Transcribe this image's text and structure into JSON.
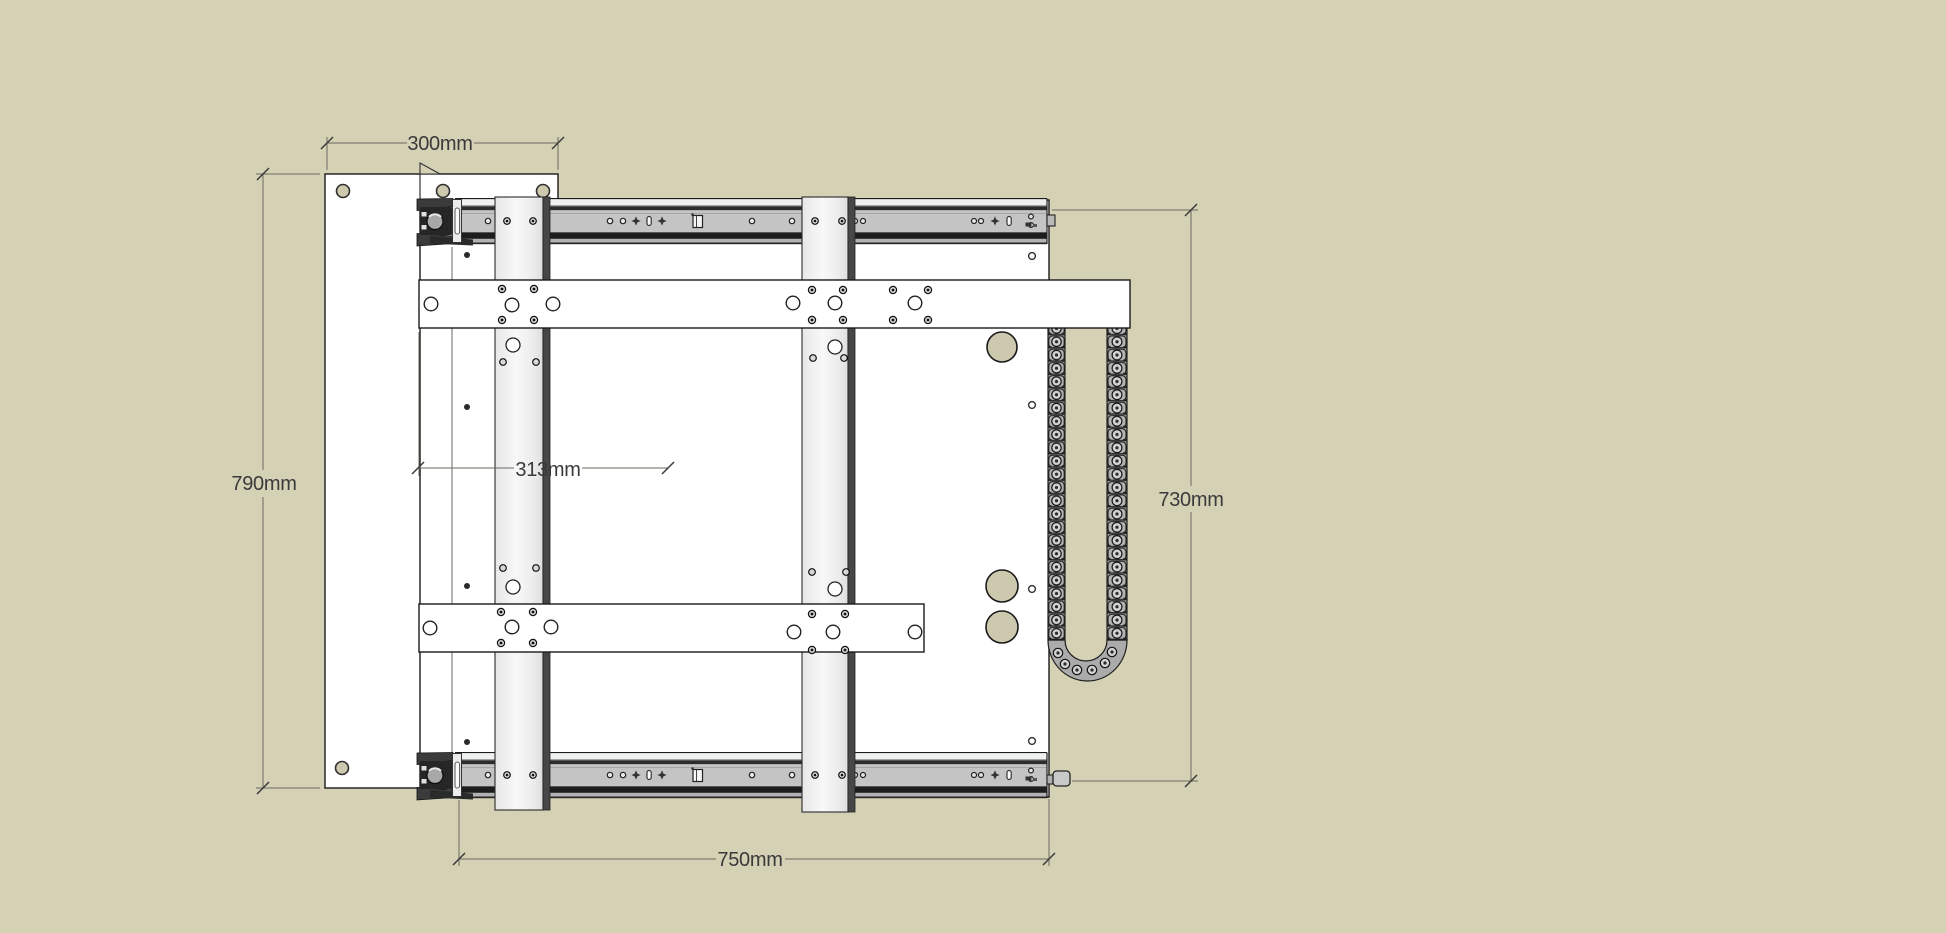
{
  "viewport": {
    "type": "cad-3d-viewport",
    "background_color": "#d4d1b5",
    "content": "Technical drawing of a sliding gantry assembly: back panel, main plate, two telescopic drawer slides, two vertical rails, two cross bars, cable drag chain"
  },
  "dimensions": {
    "panel_width": {
      "label": "300mm",
      "value_mm": 300,
      "orientation": "horizontal"
    },
    "panel_height": {
      "label": "790mm",
      "value_mm": 790,
      "orientation": "vertical"
    },
    "center_offset": {
      "label": "313mm",
      "value_mm": 313,
      "orientation": "horizontal"
    },
    "right_height": {
      "label": "730mm",
      "value_mm": 730,
      "orientation": "vertical"
    },
    "slide_length": {
      "label": "750mm",
      "value_mm": 750,
      "orientation": "horizontal"
    }
  },
  "colors": {
    "background": "#d4d1b5",
    "panel_fill": "#ffffff",
    "outline": "#1a1a1a",
    "slide_body": "#c4c4c4",
    "slide_dark_band": "#1d1d1d",
    "rail_fill": "#f0f0f1",
    "rail_dark_edge": "#474747",
    "chain_gray": "#ababab",
    "hole_beige": "#cdc9ae",
    "dimension_text": "#3a3a3a",
    "dimension_line": "#6b6b60"
  },
  "components": [
    "back-panel",
    "main-plate",
    "drawer-slide-top",
    "drawer-slide-bottom",
    "vertical-rail-left",
    "vertical-rail-right",
    "cross-bar-upper",
    "cross-bar-lower",
    "cable-chain",
    "slide-end-bracket",
    "slide-end-pin"
  ]
}
